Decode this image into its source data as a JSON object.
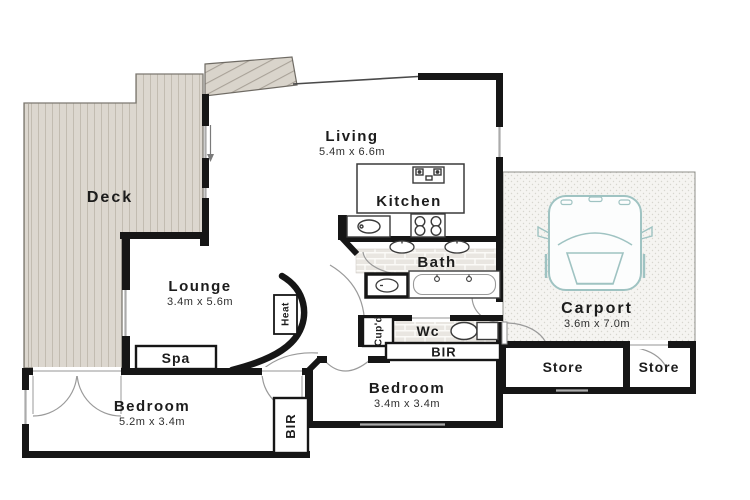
{
  "plan": {
    "title": "Floor plan",
    "rooms": {
      "deck": {
        "label": "Deck"
      },
      "living": {
        "label": "Living",
        "dims": "5.4m x 6.6m"
      },
      "kitchen": {
        "label": "Kitchen"
      },
      "bath": {
        "label": "Bath"
      },
      "lounge": {
        "label": "Lounge",
        "dims": "3.4m x 5.6m"
      },
      "spa": {
        "label": "Spa"
      },
      "heat": {
        "label": "Heat"
      },
      "wc": {
        "label": "Wc"
      },
      "cupd": {
        "label": "Cup'd"
      },
      "bir_hall": {
        "label": "BIR"
      },
      "bedroom1": {
        "label": "Bedroom",
        "dims": "5.2m x 3.4m"
      },
      "bir_bedroom1": {
        "label": "BIR"
      },
      "bedroom2": {
        "label": "Bedroom",
        "dims": "3.4m x 3.4m"
      },
      "carport": {
        "label": "Carport",
        "dims": "3.6m x 7.0m"
      },
      "store1": {
        "label": "Store"
      },
      "store2": {
        "label": "Store"
      }
    },
    "colors": {
      "wall": "#161616",
      "deck_fill": "#dcd7cf",
      "brick_fill": "#e9e6e1",
      "carport_fill": "#f5f4f1",
      "car_stroke": "#9fc3c2",
      "door_arc": "#9a9a9a"
    }
  }
}
